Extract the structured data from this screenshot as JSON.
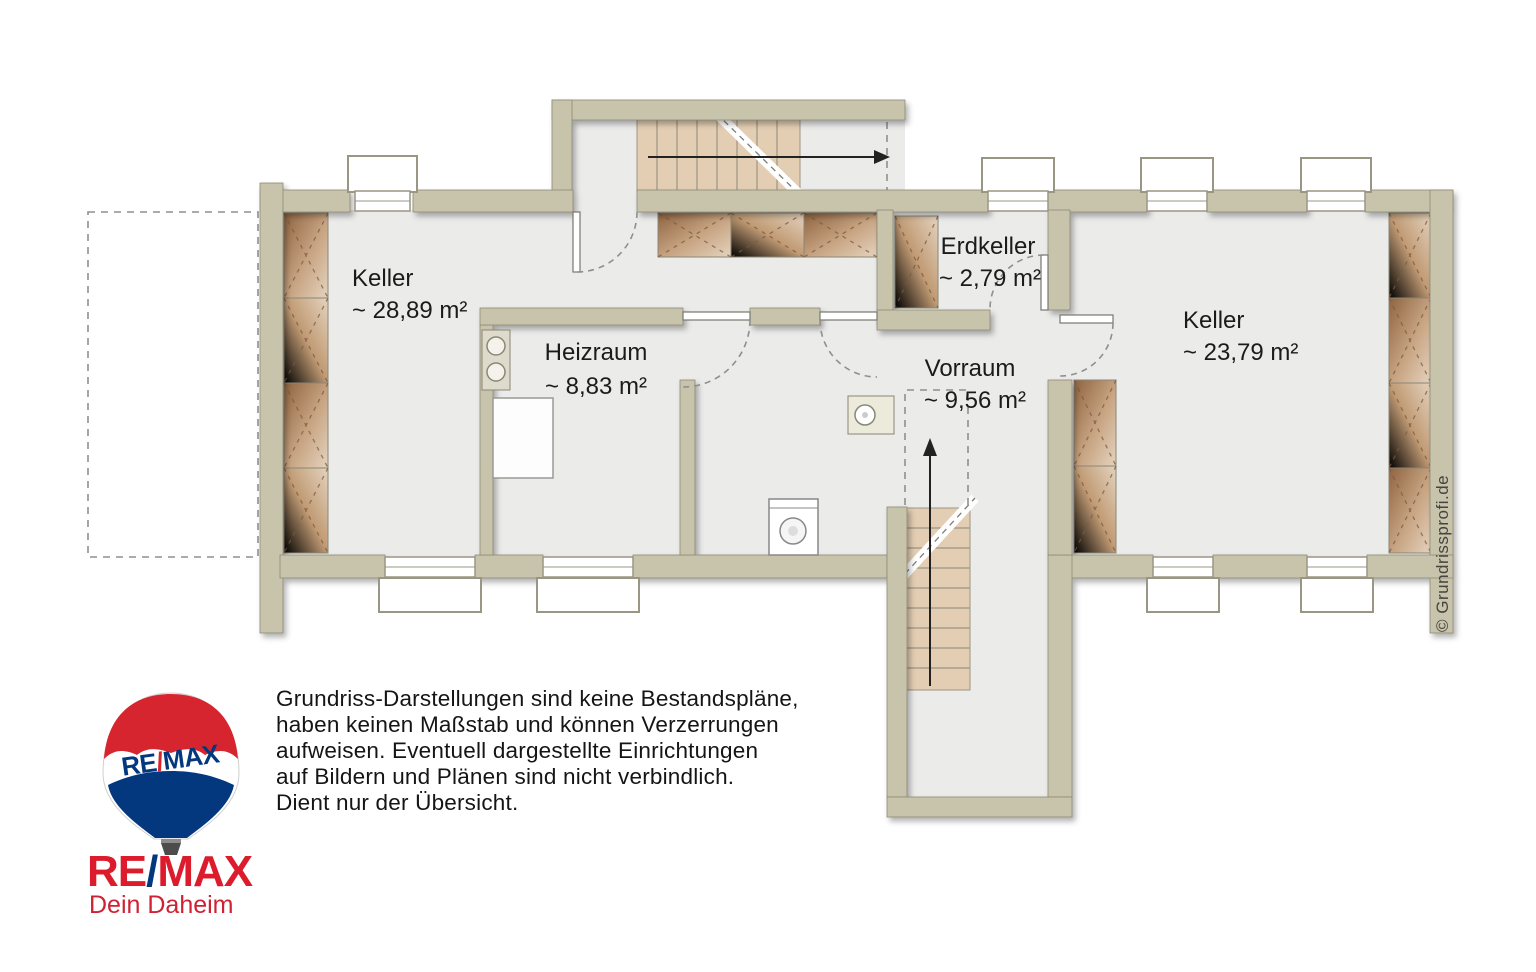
{
  "plan": {
    "rooms": [
      {
        "name": "Keller",
        "area": "~ 28,89 m²"
      },
      {
        "name": "Heizraum",
        "area": "~ 8,83 m²"
      },
      {
        "name": "Erdkeller",
        "area": "~ 2,79 m²"
      },
      {
        "name": "Vorraum",
        "area": "~ 9,56 m²"
      },
      {
        "name": "Keller",
        "area": "~ 23,79 m²"
      }
    ],
    "watermark": "© Grundrissprofi.de"
  },
  "disclaimer": {
    "lines": [
      "Grundriss-Darstellungen sind keine Bestandspläne,",
      "haben keinen Maßstab und können Verzerrungen",
      "aufweisen. Eventuell dargestellte Einrichtungen",
      "auf Bildern und Plänen sind nicht verbindlich.",
      "Dient nur der Übersicht."
    ]
  },
  "branding": {
    "re": "RE",
    "slash": "/",
    "max": "MAX",
    "tagline": "Dein Daheim"
  },
  "colors": {
    "wall": "#c8c4ab",
    "floor": "#ebebea",
    "stair": "#e3ceb3",
    "shelf": "#a97c55",
    "remax_red": "#dc1c2c",
    "remax_blue": "#03387e"
  }
}
